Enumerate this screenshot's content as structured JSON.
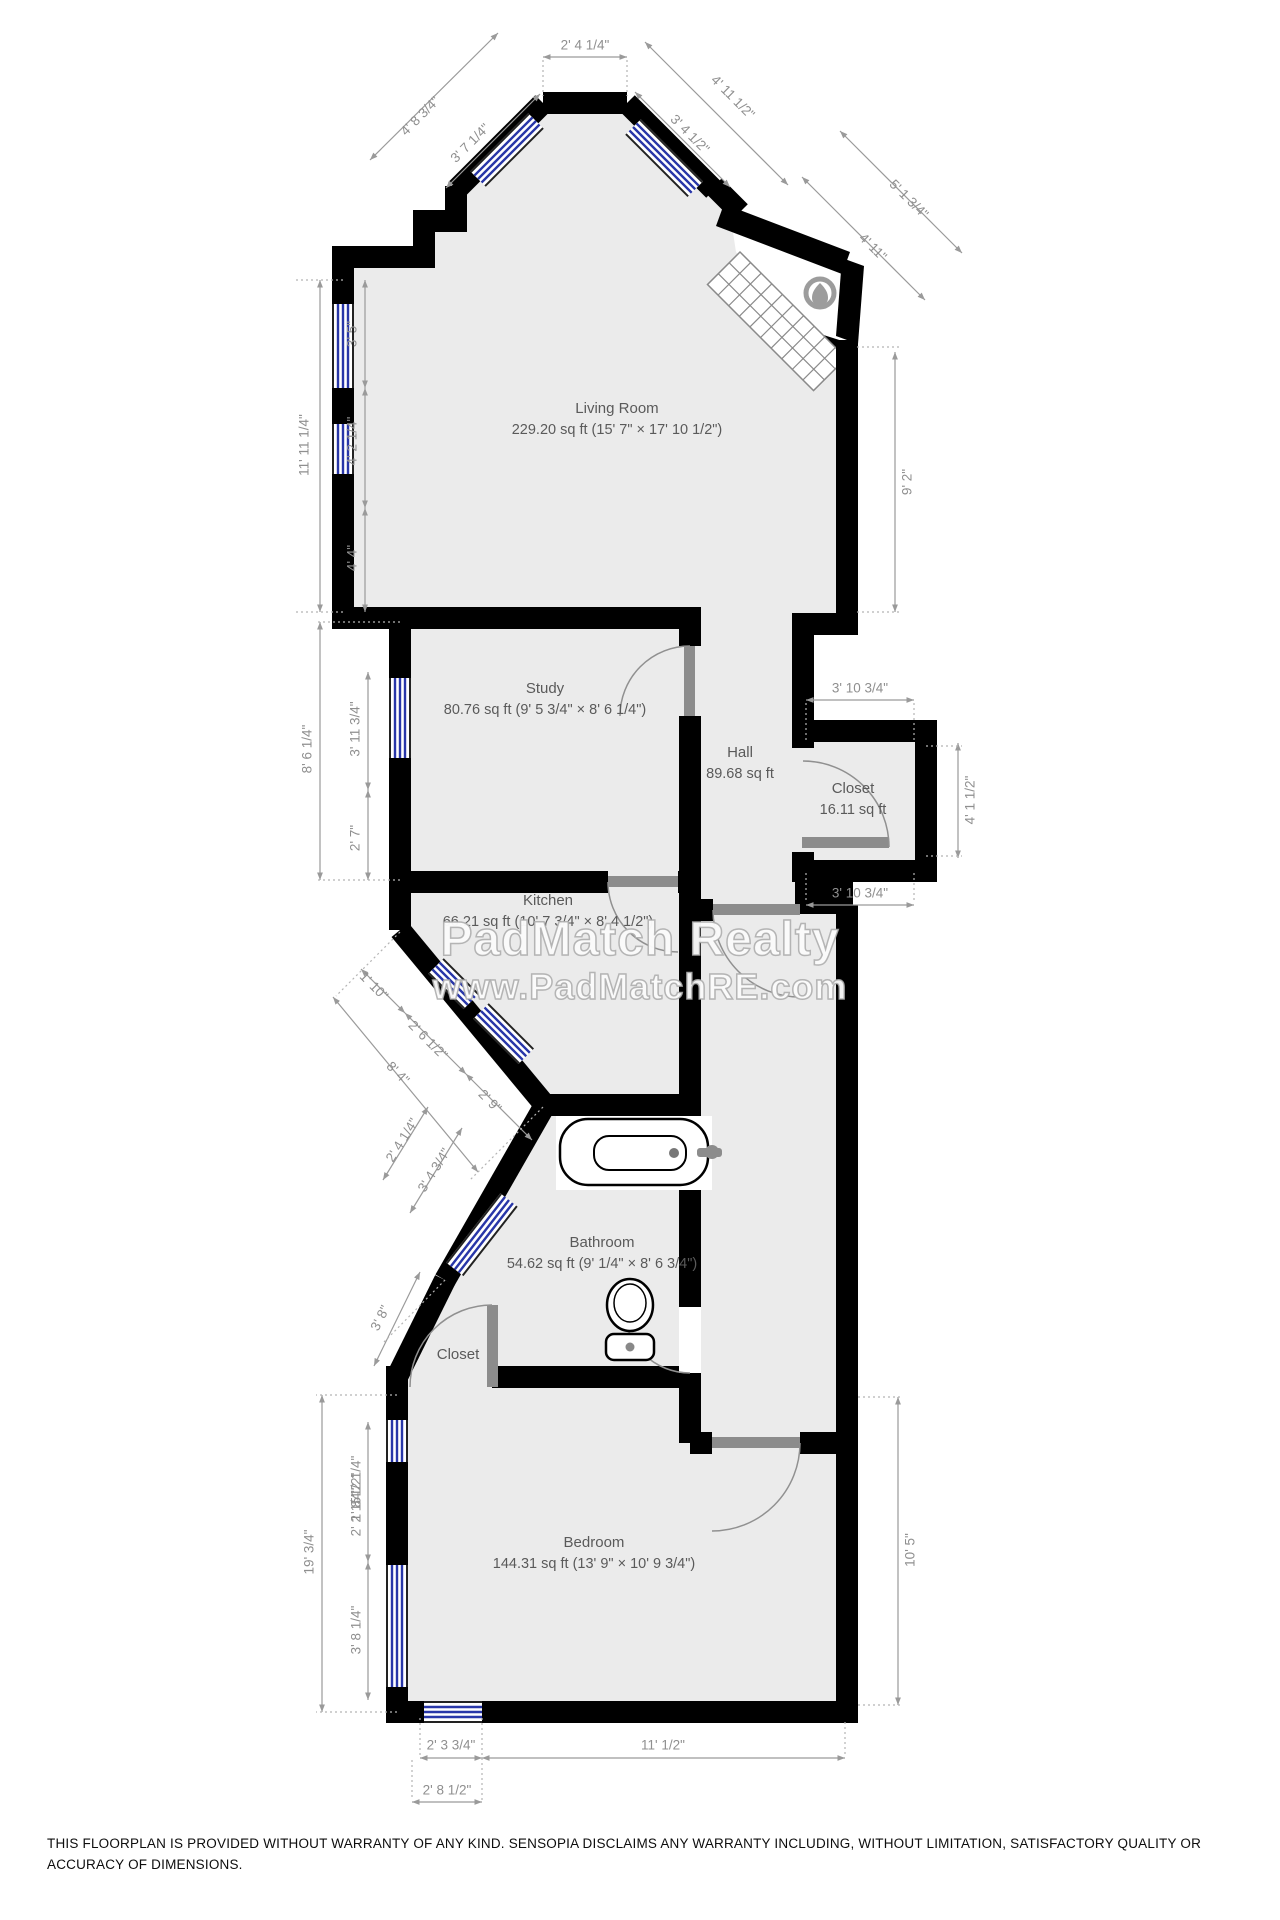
{
  "watermark": {
    "line1": "PadMatch Realty",
    "line2": "www.PadMatchRE.com"
  },
  "disclaimer": "THIS FLOORPLAN IS PROVIDED WITHOUT WARRANTY OF ANY KIND. SENSOPIA DISCLAIMS ANY WARRANTY INCLUDING, WITHOUT LIMITATION, SATISFACTORY QUALITY OR ACCURACY OF DIMENSIONS.",
  "rooms": [
    {
      "id": "living-room",
      "name": "Living Room",
      "area": "229.20 sq ft (15' 7\" × 17' 10 1/2\")",
      "x": 617,
      "y": 398
    },
    {
      "id": "study",
      "name": "Study",
      "area": "80.76 sq ft (9' 5 3/4\" × 8' 6 1/4\")",
      "x": 545,
      "y": 678
    },
    {
      "id": "hall",
      "name": "Hall",
      "area": "89.68 sq ft",
      "x": 740,
      "y": 742
    },
    {
      "id": "closet-hall",
      "name": "Closet",
      "area": "16.11 sq ft",
      "x": 853,
      "y": 778
    },
    {
      "id": "kitchen",
      "name": "Kitchen",
      "area": "66.21 sq ft (10' 7 3/4\" × 8' 4 1/2\")",
      "x": 548,
      "y": 890
    },
    {
      "id": "bathroom",
      "name": "Bathroom",
      "area": "54.62 sq ft (9' 1/4\" × 8' 6 3/4\")",
      "x": 602,
      "y": 1232
    },
    {
      "id": "closet-bedroom",
      "name": "Closet",
      "area": "",
      "x": 458,
      "y": 1344
    },
    {
      "id": "bedroom",
      "name": "Bedroom",
      "area": "144.31 sq ft (13' 9\" × 10' 9 3/4\")",
      "x": 594,
      "y": 1532
    }
  ],
  "dim_labels": [
    {
      "text": "2' 4 1/4\"",
      "x": 585,
      "y": 45,
      "rot": 0
    },
    {
      "text": "4' 8 3/4\"",
      "x": 420,
      "y": 116,
      "rot": -45
    },
    {
      "text": "3' 7 1/4\"",
      "x": 470,
      "y": 143,
      "rot": -45
    },
    {
      "text": "4' 11 1/2\"",
      "x": 733,
      "y": 97,
      "rot": 45
    },
    {
      "text": "3' 4 1/2\"",
      "x": 690,
      "y": 134,
      "rot": 45
    },
    {
      "text": "5' 1 3/4\"",
      "x": 909,
      "y": 199,
      "rot": 45
    },
    {
      "text": "4' 11\"",
      "x": 873,
      "y": 247,
      "rot": 45
    },
    {
      "text": "9' 2\"",
      "x": 907,
      "y": 482,
      "rot": -90
    },
    {
      "text": "11' 11 1/4\"",
      "x": 304,
      "y": 445,
      "rot": -90
    },
    {
      "text": "3' 5\"",
      "x": 352,
      "y": 334,
      "rot": -90
    },
    {
      "text": "4' 2 1/4\"",
      "x": 352,
      "y": 441,
      "rot": -90
    },
    {
      "text": "4' 4\"",
      "x": 352,
      "y": 558,
      "rot": -90
    },
    {
      "text": "8' 6 1/4\"",
      "x": 307,
      "y": 749,
      "rot": -90
    },
    {
      "text": "3' 11 3/4\"",
      "x": 355,
      "y": 729,
      "rot": -90
    },
    {
      "text": "2' 7\"",
      "x": 355,
      "y": 838,
      "rot": -90
    },
    {
      "text": "3' 10 3/4\"",
      "x": 860,
      "y": 688,
      "rot": 0
    },
    {
      "text": "4' 1 1/2\"",
      "x": 970,
      "y": 800,
      "rot": -90
    },
    {
      "text": "3' 10 3/4\"",
      "x": 860,
      "y": 893,
      "rot": 0
    },
    {
      "text": "1' 10\"",
      "x": 374,
      "y": 986,
      "rot": 45
    },
    {
      "text": "2' 6 1/2\"",
      "x": 428,
      "y": 1040,
      "rot": 45
    },
    {
      "text": "8' 4\"",
      "x": 398,
      "y": 1073,
      "rot": 45
    },
    {
      "text": "2' 9\"",
      "x": 490,
      "y": 1101,
      "rot": 45
    },
    {
      "text": "2' 4 1/4\"",
      "x": 402,
      "y": 1140,
      "rot": -58
    },
    {
      "text": "3' 4 3/4\"",
      "x": 434,
      "y": 1170,
      "rot": -58
    },
    {
      "text": "3' 8\"",
      "x": 380,
      "y": 1318,
      "rot": -63
    },
    {
      "text": "19' 3/4\"",
      "x": 309,
      "y": 1552,
      "rot": -90
    },
    {
      "text": "5' 2 1/4\"",
      "x": 356,
      "y": 1480,
      "rot": -90
    },
    {
      "text": "1' 8 1/2\"",
      "x": 356,
      "y": 1497,
      "rot": -90
    },
    {
      "text": "2' 2 1/4\"",
      "x": 356,
      "y": 1512,
      "rot": -90
    },
    {
      "text": "3' 8 1/4\"",
      "x": 356,
      "y": 1630,
      "rot": -90
    },
    {
      "text": "10' 5\"",
      "x": 910,
      "y": 1550,
      "rot": -90
    },
    {
      "text": "2' 3 3/4\"",
      "x": 451,
      "y": 1745,
      "rot": 0
    },
    {
      "text": "11' 1/2\"",
      "x": 663,
      "y": 1745,
      "rot": 0
    },
    {
      "text": "2' 8 1/2\"",
      "x": 447,
      "y": 1790,
      "rot": 0
    }
  ],
  "colors": {
    "wall": "#000000",
    "floor": "#ebebeb",
    "window_blue": "#2836a8",
    "dimension_gray": "#9a9a9a",
    "label_gray": "#5a5a5a",
    "door_gray": "#8c8c8c"
  }
}
